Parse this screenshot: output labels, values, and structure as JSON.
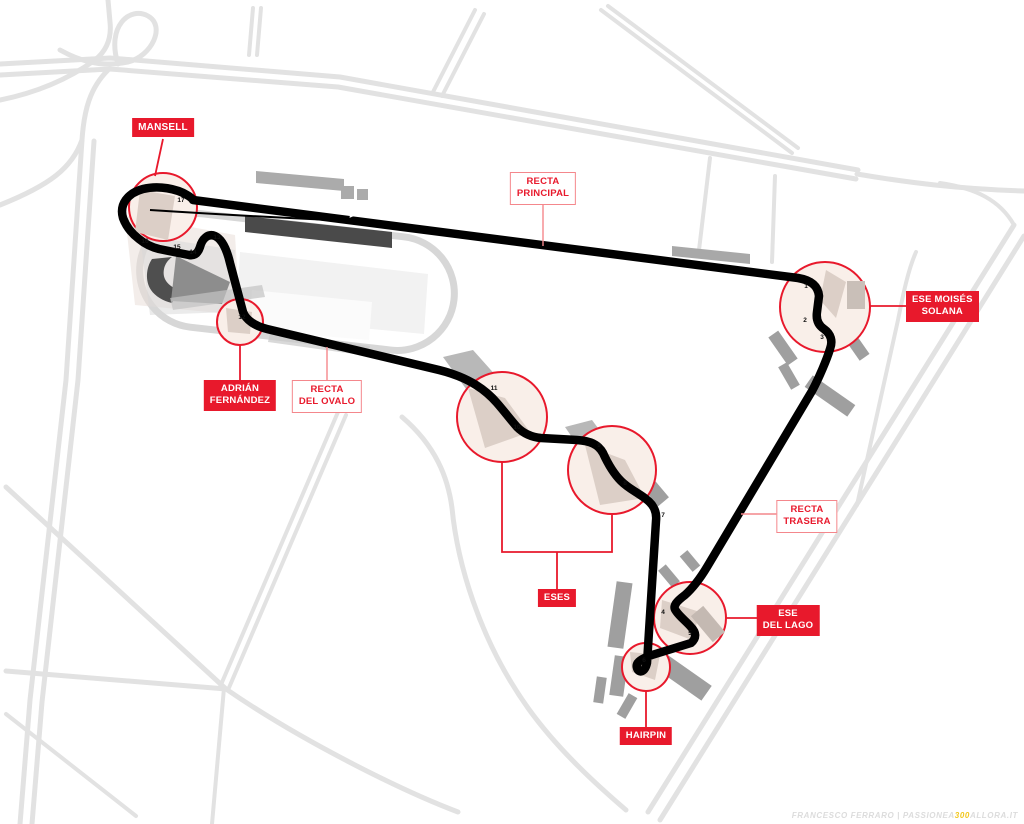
{
  "map": {
    "subject": "race-circuit-map",
    "labels": {
      "mansell": "MANSELL",
      "recta_principal": "RECTA\nPRINCIPAL",
      "ese_moises_solana": "ESE MOISÉS\nSOLANA",
      "adrian_fernandez": "ADRIÁN\nFERNÁNDEZ",
      "recta_del_ovalo": "RECTA\nDEL OVALO",
      "eses": "ESES",
      "recta_trasera": "RECTA\nTRASERA",
      "ese_del_lago": "ESE\nDEL LAGO",
      "hairpin": "HAIRPIN"
    },
    "turns": [
      {
        "n": "1",
        "x": 806,
        "y": 288
      },
      {
        "n": "2",
        "x": 805,
        "y": 322
      },
      {
        "n": "3",
        "x": 822,
        "y": 339
      },
      {
        "n": "4",
        "x": 663,
        "y": 614
      },
      {
        "n": "5",
        "x": 690,
        "y": 635
      },
      {
        "n": "6",
        "x": 644,
        "y": 662
      },
      {
        "n": "7",
        "x": 663,
        "y": 517
      },
      {
        "n": "8",
        "x": 625,
        "y": 485
      },
      {
        "n": "9",
        "x": 599,
        "y": 447
      },
      {
        "n": "10",
        "x": 517,
        "y": 429
      },
      {
        "n": "11",
        "x": 494,
        "y": 390
      },
      {
        "n": "12",
        "x": 242,
        "y": 319
      },
      {
        "n": "13",
        "x": 217,
        "y": 239
      },
      {
        "n": "14",
        "x": 193,
        "y": 254
      },
      {
        "n": "15",
        "x": 177,
        "y": 249
      },
      {
        "n": "16",
        "x": 145,
        "y": 243
      },
      {
        "n": "17",
        "x": 181,
        "y": 202
      }
    ],
    "direction_arrow": "right",
    "colors": {
      "accent": "#e8192c",
      "soft_connector": "#f4878c",
      "track": "#000000",
      "road": "#e2e2e2",
      "highlight_circle_fill": "#f9efe9",
      "watermark_highlight": "#f2c71d"
    }
  },
  "watermark": {
    "prefix": "FRANCESCO FERRARO | PASSIONEA",
    "highlight": "300",
    "suffix": "ALLORA.IT"
  }
}
